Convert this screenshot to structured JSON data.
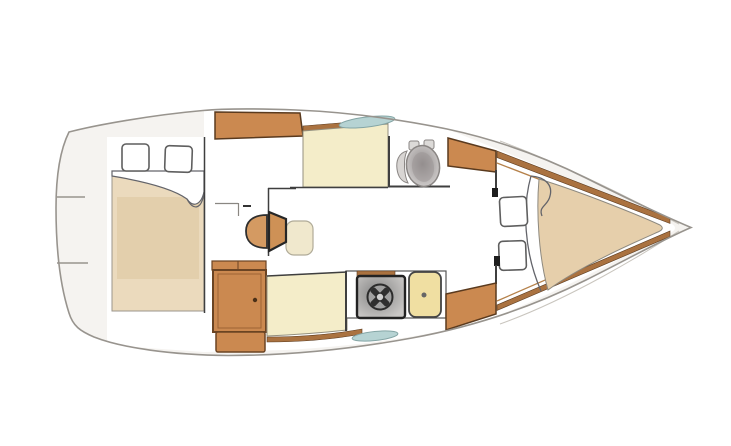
{
  "diagram": {
    "title": "Sailing yacht interior layout plan — top view, bow to the right",
    "type": "boat-floorplan",
    "orientation": {
      "bow": "right",
      "stern": "left"
    },
    "rooms": [
      {
        "id": "aft-cabin",
        "label": "Double-berth cabin (left)",
        "features": [
          "double berth with turned sheet",
          "2 pillows"
        ]
      },
      {
        "id": "saloon",
        "label": "Main saloon",
        "features": [
          "upper settee",
          "lower settee",
          "folding table",
          "wardrobe locker",
          "storage locker"
        ]
      },
      {
        "id": "head",
        "label": "Head compartment",
        "features": [
          "marine toilet"
        ]
      },
      {
        "id": "galley",
        "label": "Galley",
        "features": [
          "burner stove",
          "sink with drain"
        ]
      },
      {
        "id": "bow-cabin",
        "label": "V-berth cabin (right)",
        "features": [
          "V-berth with turned sheet",
          "2 pillows"
        ]
      }
    ],
    "fixtures": {
      "hull_windows": 2,
      "pillows_total": 4,
      "companionway_ticks": 2
    }
  },
  "palette": {
    "hull_fill": "#f5f3f0",
    "hull_line": "#98948e",
    "sheer_line": "#c9c5be",
    "room_fill": "#ffffff",
    "wood": "#cb8950",
    "wood_border": "#6b4423",
    "wood_inner": "#9c6234",
    "trim_brown": "#aa7240",
    "trim_edge": "#5a3a1e",
    "settee": "#f4edc9",
    "settee_line": "#94907f",
    "sink_yellow": "#f0dfa2",
    "bed_tan": "#ebdabd",
    "quilt_tan": "#e3cfac",
    "vberth_tan": "#e6cfab",
    "table_tan": "#d49a62",
    "table_trap": "#ce9156",
    "table_leaf": "#f0e8cd",
    "window_teal": "#b6d3d3",
    "window_edge": "#84a5a5",
    "stove_dark": "#848484",
    "stove_light": "#c9c7c5",
    "toilet_dark": "#8e8989",
    "toilet_light": "#d8d5d4",
    "wall_dark": "#3f3f3f",
    "sheet_line": "#63646a",
    "pillow_line": "#5f5f5f"
  }
}
